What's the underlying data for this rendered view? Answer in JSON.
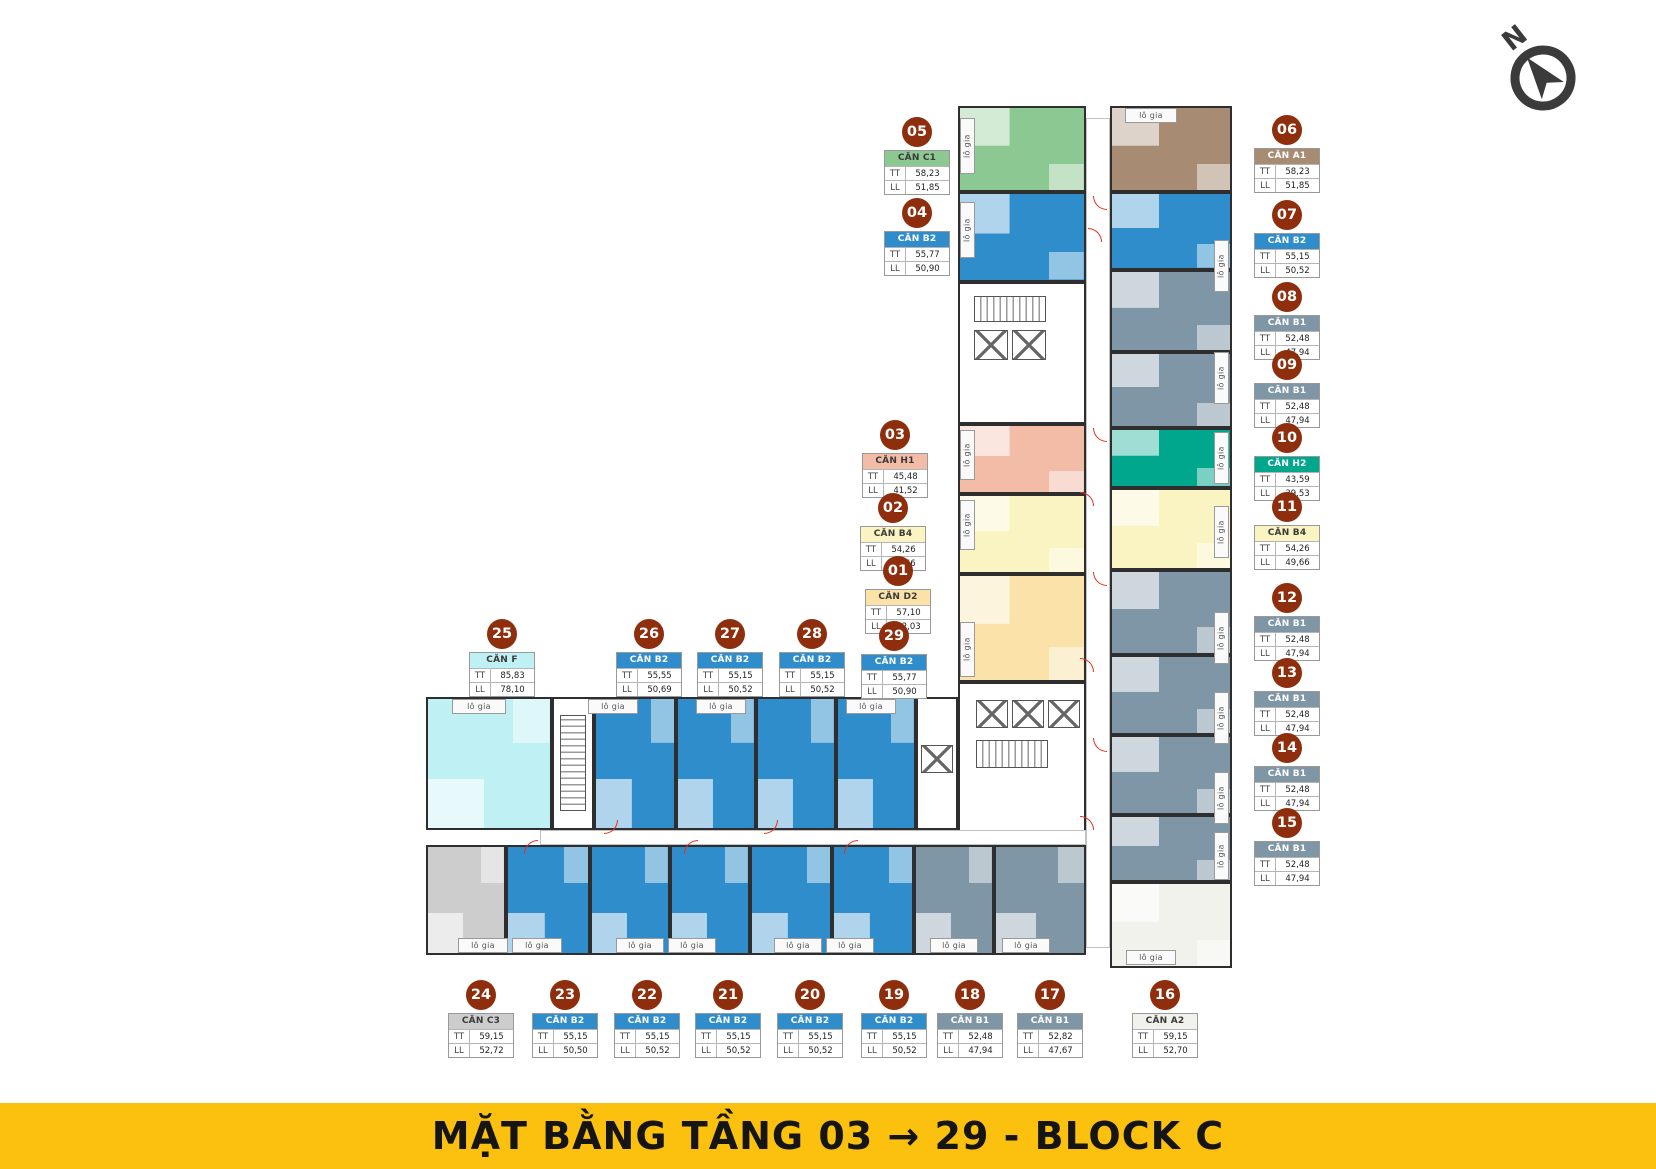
{
  "title_banner": {
    "text": "MẶT BẰNG TẦNG 03 → 29 - BLOCK C",
    "bg_color": "#FCC00F",
    "text_color": "#151515"
  },
  "compass": {
    "label": "N"
  },
  "labels": {
    "tt": "TT",
    "ll": "LL",
    "lo_gia": "lô gia"
  },
  "badge_color": "#8E2E0D",
  "units": {
    "u01": {
      "no": "01",
      "name": "CĂN D2",
      "tt": "57,10",
      "ll": "52,03",
      "color": "#FAE2A9",
      "text": "#3A3A3A"
    },
    "u02": {
      "no": "02",
      "name": "CĂN B4",
      "tt": "54,26",
      "ll": "49,66",
      "color": "#FAF4C2",
      "text": "#3A3A3A"
    },
    "u03": {
      "no": "03",
      "name": "CĂN H1",
      "tt": "45,48",
      "ll": "41,52",
      "color": "#F2BCA7",
      "text": "#3A3A3A"
    },
    "u04": {
      "no": "04",
      "name": "CĂN B2",
      "tt": "55,77",
      "ll": "50,90",
      "color": "#2F8DCC",
      "text": "#FFFFFF"
    },
    "u05": {
      "no": "05",
      "name": "CĂN C1",
      "tt": "58,23",
      "ll": "51,85",
      "color": "#8CC891",
      "text": "#3A3A3A"
    },
    "u06": {
      "no": "06",
      "name": "CĂN A1",
      "tt": "58,23",
      "ll": "51,85",
      "color": "#A78C73",
      "text": "#FFFFFF"
    },
    "u07": {
      "no": "07",
      "name": "CĂN B2",
      "tt": "55,15",
      "ll": "50,52",
      "color": "#2F8DCC",
      "text": "#FFFFFF"
    },
    "u08": {
      "no": "08",
      "name": "CĂN B1",
      "tt": "52,48",
      "ll": "47,94",
      "color": "#7E96A6",
      "text": "#FFFFFF"
    },
    "u09": {
      "no": "09",
      "name": "CĂN B1",
      "tt": "52,48",
      "ll": "47,94",
      "color": "#7E96A6",
      "text": "#FFFFFF"
    },
    "u10": {
      "no": "10",
      "name": "CĂN H2",
      "tt": "43,59",
      "ll": "39,53",
      "color": "#00A78C",
      "text": "#FFFFFF"
    },
    "u11": {
      "no": "11",
      "name": "CĂN B4",
      "tt": "54,26",
      "ll": "49,66",
      "color": "#FAF4C2",
      "text": "#3A3A3A"
    },
    "u12": {
      "no": "12",
      "name": "CĂN B1",
      "tt": "52,48",
      "ll": "47,94",
      "color": "#7E96A6",
      "text": "#FFFFFF"
    },
    "u13": {
      "no": "13",
      "name": "CĂN B1",
      "tt": "52,48",
      "ll": "47,94",
      "color": "#7E96A6",
      "text": "#FFFFFF"
    },
    "u14": {
      "no": "14",
      "name": "CĂN B1",
      "tt": "52,48",
      "ll": "47,94",
      "color": "#7E96A6",
      "text": "#FFFFFF"
    },
    "u15": {
      "no": "15",
      "name": "CĂN B1",
      "tt": "52,48",
      "ll": "47,94",
      "color": "#7E96A6",
      "text": "#FFFFFF"
    },
    "u16": {
      "no": "16",
      "name": "CĂN A2",
      "tt": "59,15",
      "ll": "52,70",
      "color": "#F2F2EC",
      "text": "#3A3A3A"
    },
    "u17": {
      "no": "17",
      "name": "CĂN B1",
      "tt": "52,82",
      "ll": "47,67",
      "color": "#7E96A6",
      "text": "#FFFFFF"
    },
    "u18": {
      "no": "18",
      "name": "CĂN B1",
      "tt": "52,48",
      "ll": "47,94",
      "color": "#7E96A6",
      "text": "#FFFFFF"
    },
    "u19": {
      "no": "19",
      "name": "CĂN B2",
      "tt": "55,15",
      "ll": "50,52",
      "color": "#2F8DCC",
      "text": "#FFFFFF"
    },
    "u20": {
      "no": "20",
      "name": "CĂN B2",
      "tt": "55,15",
      "ll": "50,52",
      "color": "#2F8DCC",
      "text": "#FFFFFF"
    },
    "u21": {
      "no": "21",
      "name": "CĂN B2",
      "tt": "55,15",
      "ll": "50,52",
      "color": "#2F8DCC",
      "text": "#FFFFFF"
    },
    "u22": {
      "no": "22",
      "name": "CĂN B2",
      "tt": "55,15",
      "ll": "50,52",
      "color": "#2F8DCC",
      "text": "#FFFFFF"
    },
    "u23": {
      "no": "23",
      "name": "CĂN B2",
      "tt": "55,15",
      "ll": "50,50",
      "color": "#2F8DCC",
      "text": "#FFFFFF"
    },
    "u24": {
      "no": "24",
      "name": "CĂN C3",
      "tt": "59,15",
      "ll": "52,72",
      "color": "#CDCDCD",
      "text": "#3A3A3A"
    },
    "u25": {
      "no": "25",
      "name": "CĂN F",
      "tt": "85,83",
      "ll": "78,10",
      "color": "#BFF0F4",
      "text": "#3A3A3A"
    },
    "u26": {
      "no": "26",
      "name": "CĂN B2",
      "tt": "55,55",
      "ll": "50,69",
      "color": "#2F8DCC",
      "text": "#FFFFFF"
    },
    "u27": {
      "no": "27",
      "name": "CĂN B2",
      "tt": "55,15",
      "ll": "50,52",
      "color": "#2F8DCC",
      "text": "#FFFFFF"
    },
    "u28": {
      "no": "28",
      "name": "CĂN B2",
      "tt": "55,15",
      "ll": "50,52",
      "color": "#2F8DCC",
      "text": "#FFFFFF"
    },
    "u29": {
      "no": "29",
      "name": "CĂN B2",
      "tt": "55,77",
      "ll": "50,90",
      "color": "#2F8DCC",
      "text": "#FFFFFF"
    }
  }
}
